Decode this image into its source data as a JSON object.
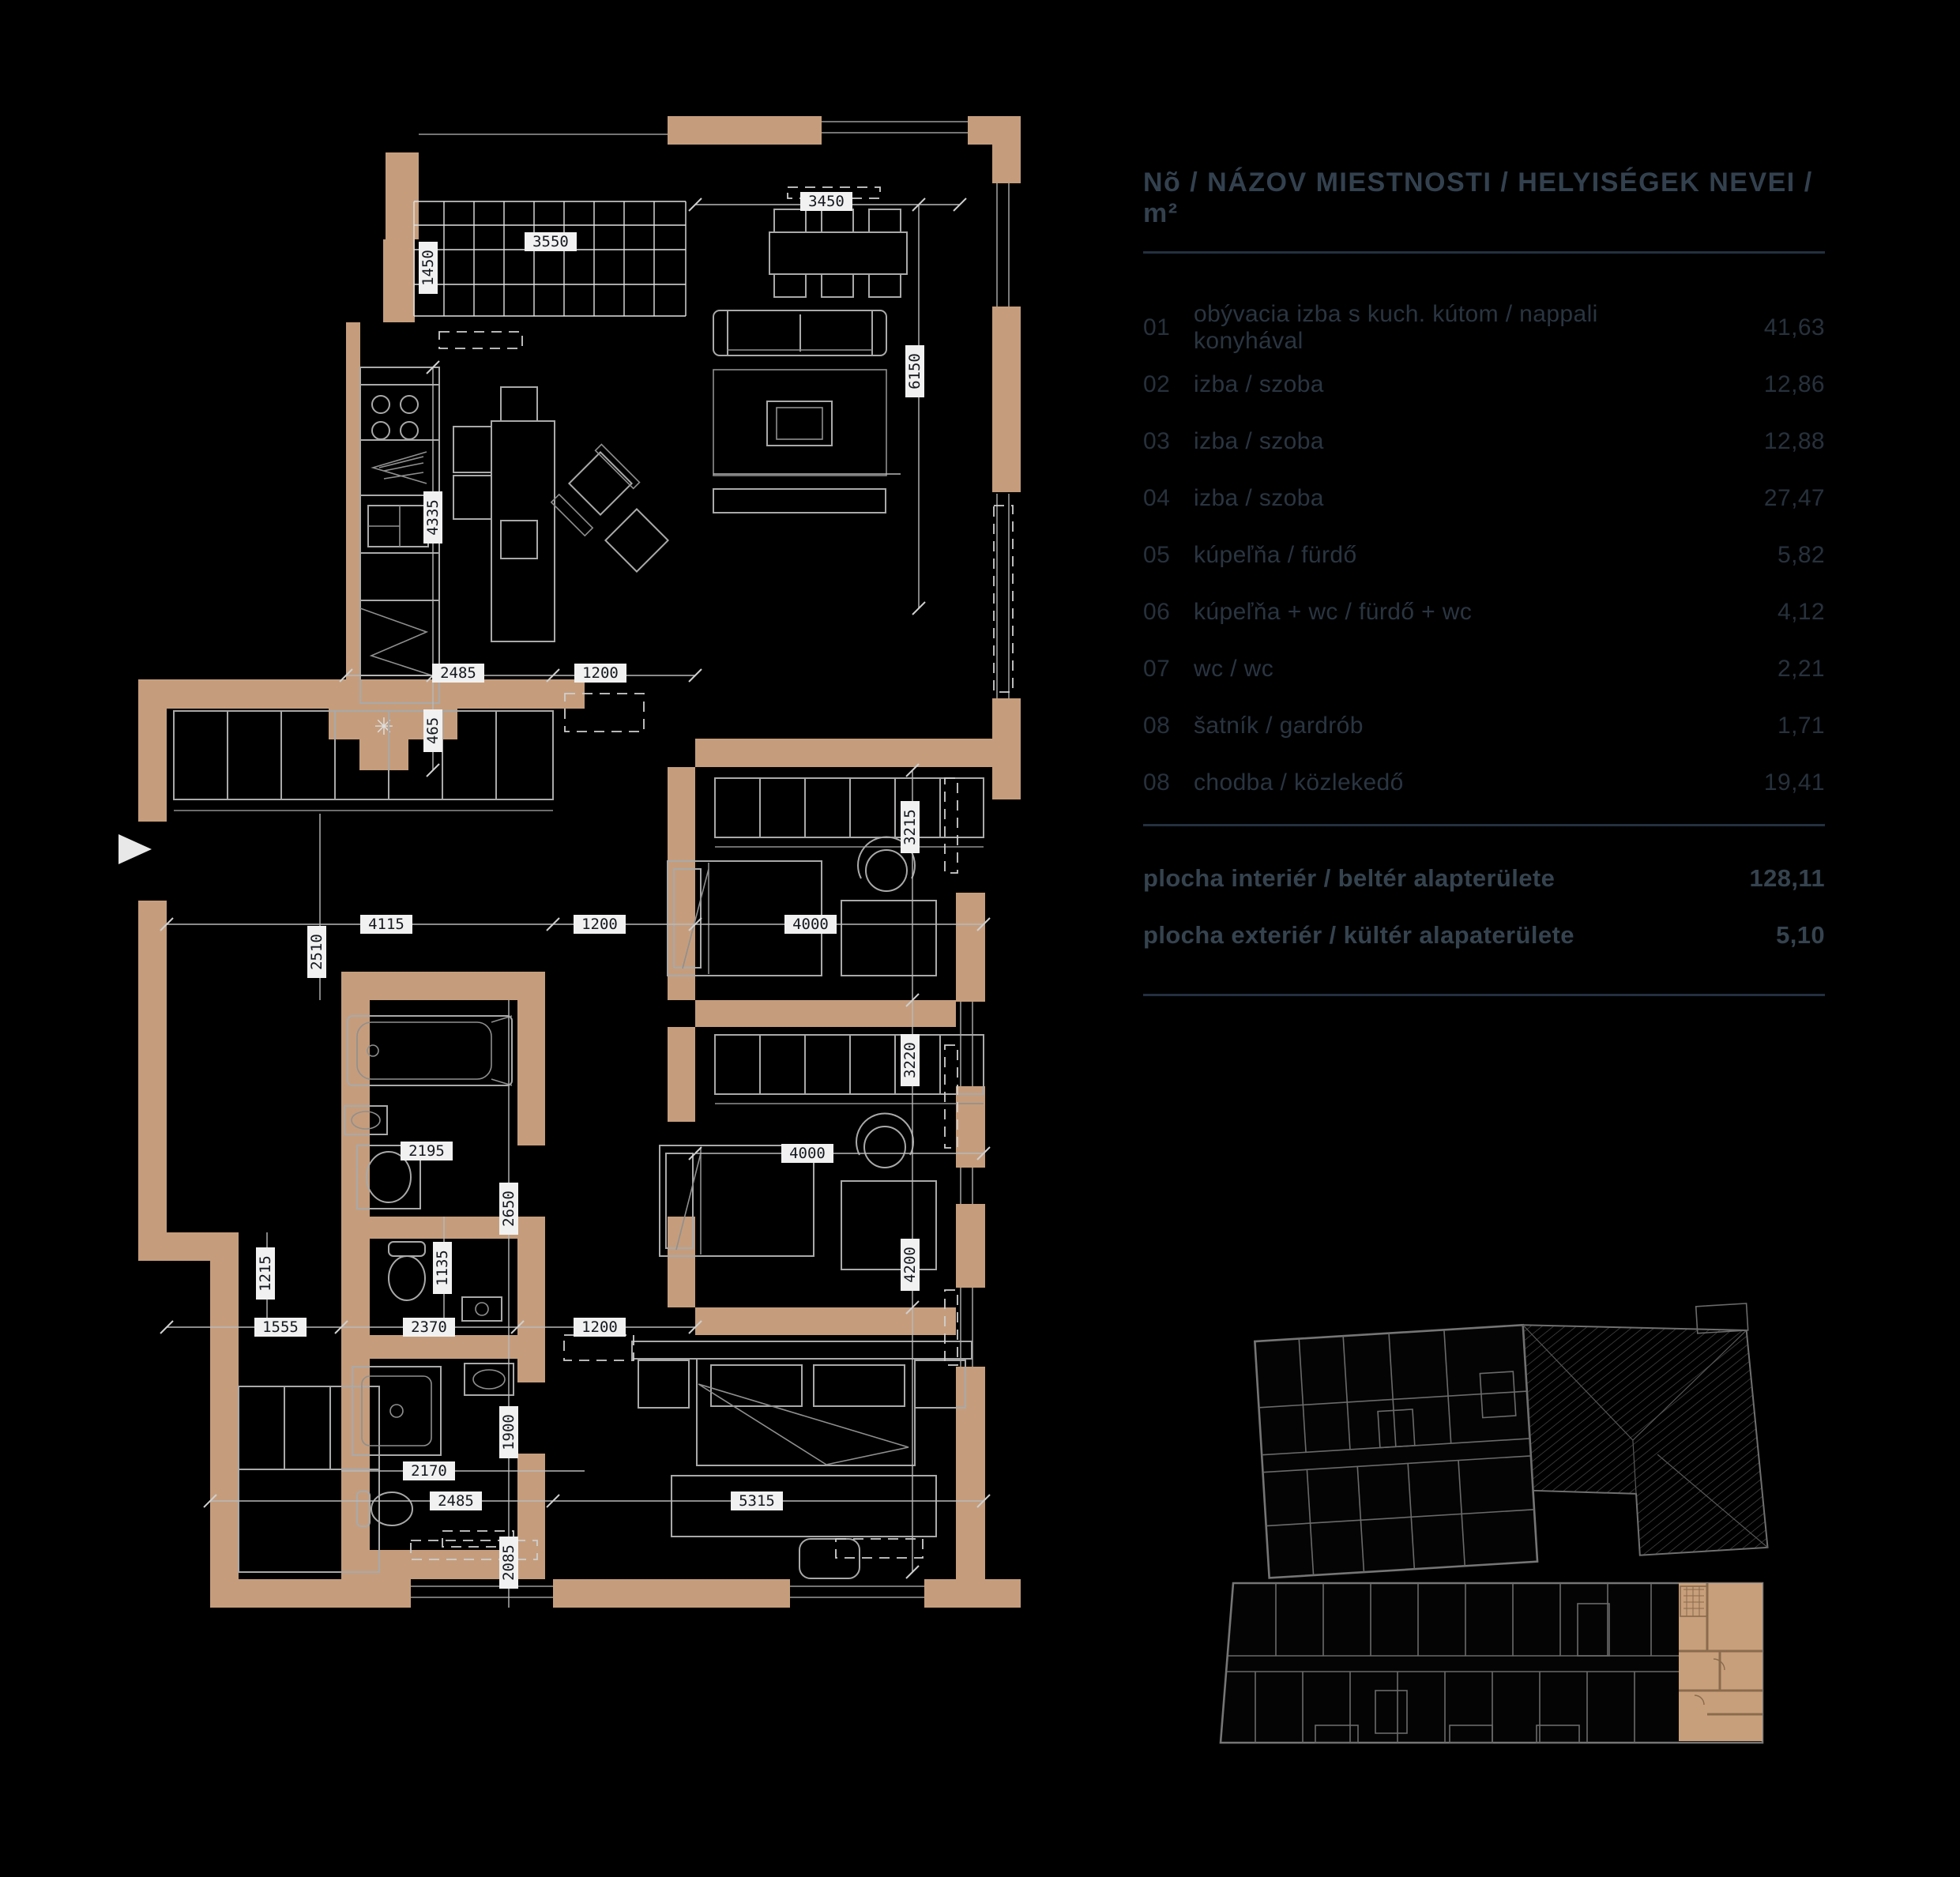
{
  "panel": {
    "title": "Nõ / NÁZOV MIESTNOSTI / HELYISÉGEK NEVEI / m²",
    "rows": [
      {
        "no": "01",
        "name": "obývacia izba s kuch. kútom / nappali konyhával",
        "area": "41,63"
      },
      {
        "no": "02",
        "name": "izba / szoba",
        "area": "12,86"
      },
      {
        "no": "03",
        "name": "izba / szoba",
        "area": "12,88"
      },
      {
        "no": "04",
        "name": "izba / szoba",
        "area": "27,47"
      },
      {
        "no": "05",
        "name": "kúpeľňa / fürdő",
        "area": "5,82"
      },
      {
        "no": "06",
        "name": "kúpeľňa + wc / fürdő + wc",
        "area": "4,12"
      },
      {
        "no": "07",
        "name": "wc / wc",
        "area": "2,21"
      },
      {
        "no": "08",
        "name": "šatník / gardrób",
        "area": "1,71"
      },
      {
        "no": "08",
        "name": "chodba / közlekedő",
        "area": "19,41"
      }
    ],
    "totals": [
      {
        "label": "plocha interiér / beltér alapterülete",
        "value": "128,11"
      },
      {
        "label": "plocha exteriér / kültér alapaterülete",
        "value": "5,10"
      }
    ]
  },
  "plan": {
    "dims": [
      "3550",
      "1450",
      "3450",
      "6150",
      "2485",
      "1200",
      "4335",
      "465",
      "4115",
      "1200",
      "4000",
      "2510",
      "3215",
      "4000",
      "3220",
      "2195",
      "2650",
      "1555",
      "2370",
      "1200",
      "1215",
      "1135",
      "2170",
      "1900",
      "2485",
      "5315",
      "2085",
      "4200"
    ]
  },
  "colors": {
    "wall": "#c59d7c",
    "accent_unit": "#c89f7b",
    "line": "#a9a9a9",
    "panel_text": "#2a3541"
  }
}
